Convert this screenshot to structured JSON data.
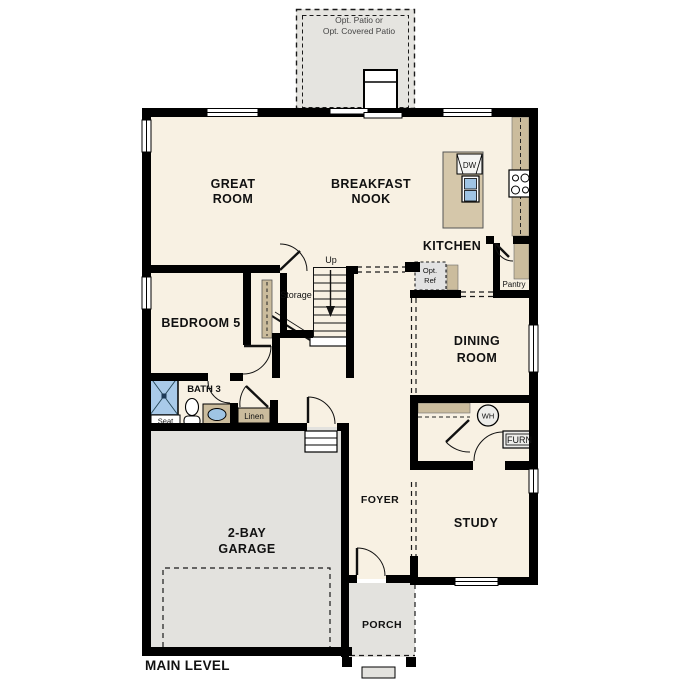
{
  "title": "MAIN LEVEL",
  "patio": {
    "line1": "Opt. Patio or",
    "line2": "Opt. Covered Patio"
  },
  "rooms": {
    "great_room": [
      "GREAT",
      "ROOM"
    ],
    "breakfast_nook": [
      "BREAKFAST",
      "NOOK"
    ],
    "kitchen": "KITCHEN",
    "bedroom5": "BEDROOM 5",
    "bath3": "BATH 3",
    "dining_room": [
      "DINING",
      "ROOM"
    ],
    "study": "STUDY",
    "foyer": "FOYER",
    "garage": [
      "2-BAY",
      "GARAGE"
    ],
    "porch": "PORCH"
  },
  "features": {
    "storage": "Storage",
    "up": "Up",
    "seat": "Seat",
    "linen": "Linen",
    "pantry": "Pantry",
    "opt_ref_line1": "Opt.",
    "opt_ref_line2": "Ref",
    "dishwasher": "DW",
    "water_heater": "WH",
    "furnace": "FURN"
  },
  "colors": {
    "wall": "#000000",
    "floor": "#f8f1e3",
    "garage_floor": "#e3e2de",
    "patio_floor": "#e5e4e0",
    "porch_floor": "#e3e2de",
    "counter": "#cbbc9d",
    "island": "#d5c7aa",
    "shower_blue": "#a9cae9",
    "sink_blue": "#9fc4e4",
    "optional_fill": "#e2e2e2",
    "appliance_fill": "#ededea"
  }
}
